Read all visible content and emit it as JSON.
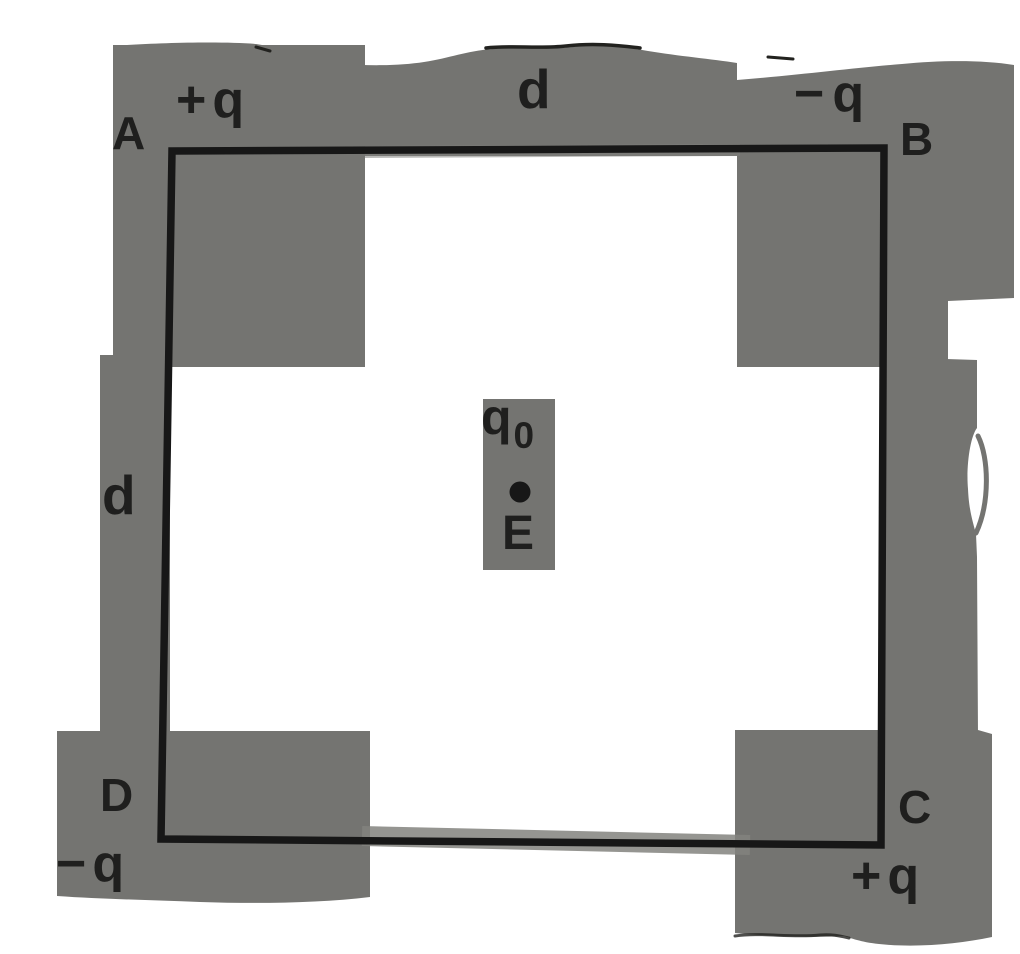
{
  "colors": {
    "highlight": "#747471",
    "ink": "#1f1f1e",
    "line": "#171717",
    "paper": "#ffffff"
  },
  "labels": {
    "corner_a": "A",
    "charge_a": "+q",
    "corner_b": "B",
    "charge_b": "−q",
    "corner_c": "C",
    "charge_c": "+q",
    "corner_d": "D",
    "charge_d": "−q",
    "side_top": "d",
    "side_left": "d",
    "center_charge": "q",
    "center_charge_sub": "0",
    "center_field": "E"
  }
}
